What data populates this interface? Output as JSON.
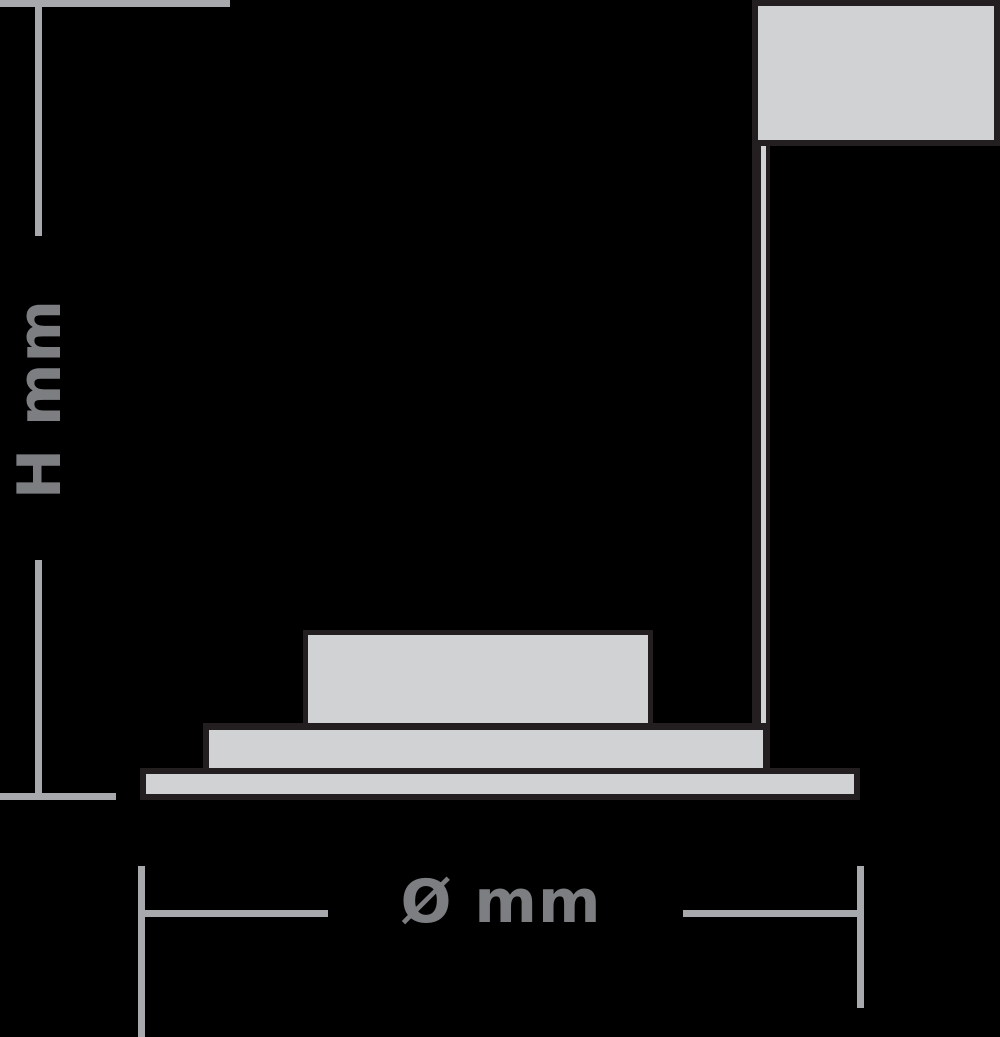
{
  "diagram": {
    "type": "luminaire-dimension-drawing",
    "height_label": "H mm",
    "diameter_label": "Ø mm"
  },
  "colors": {
    "background": "#000000",
    "fixture_fill": "#d0d2d3",
    "fixture_stroke": "#231f20",
    "dimension_line": "#a7a9ac",
    "label_text": "#7d7e82"
  }
}
